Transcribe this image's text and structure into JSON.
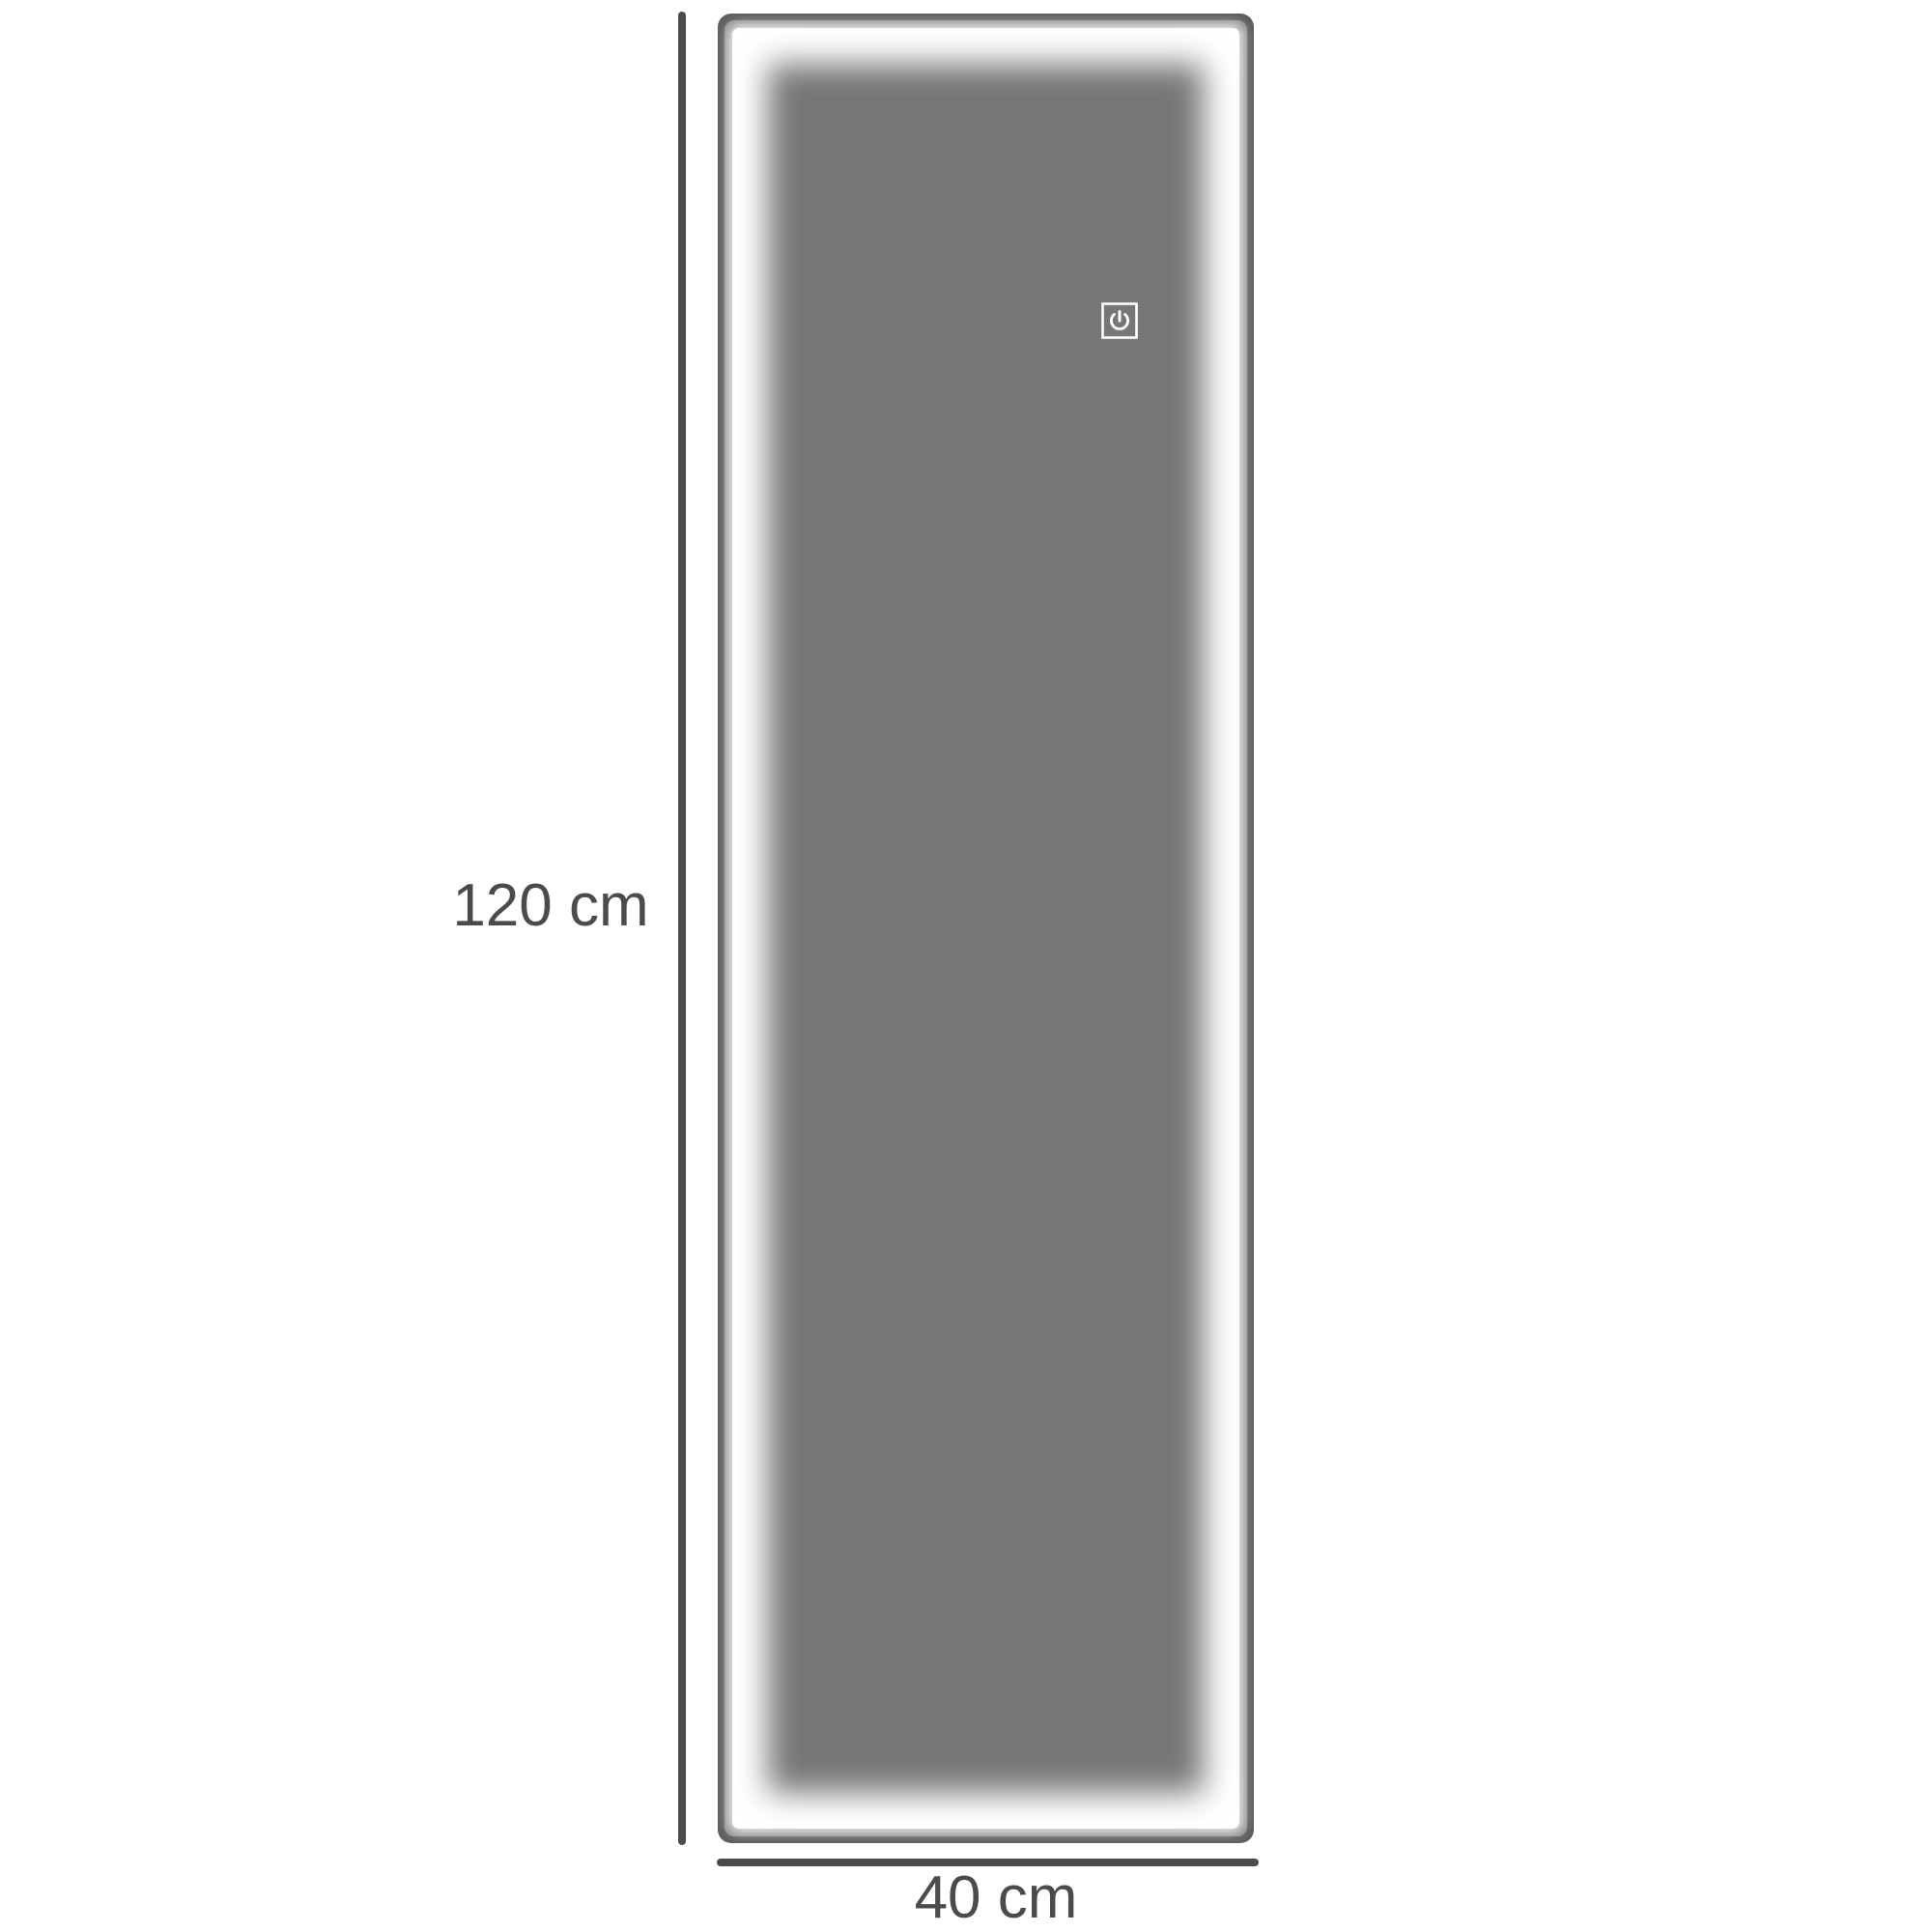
{
  "page": {
    "title": "LED wall mirror dimension diagram",
    "background": "#ffffff"
  },
  "colors": {
    "page_bg": "#ffffff",
    "dimension_line": "#4b4b4b",
    "label_text": "#4b4b4b",
    "frame_outer": "#5e5e5e",
    "frame_inner": "#8e8e8e",
    "led_glow": "#ffffff",
    "glass": "#767676",
    "icon_stroke": "#ffffff"
  },
  "dimensions": {
    "height_label": "120 cm",
    "width_label": "40 cm"
  },
  "mirror": {
    "power_icon": "power-touch-icon"
  }
}
